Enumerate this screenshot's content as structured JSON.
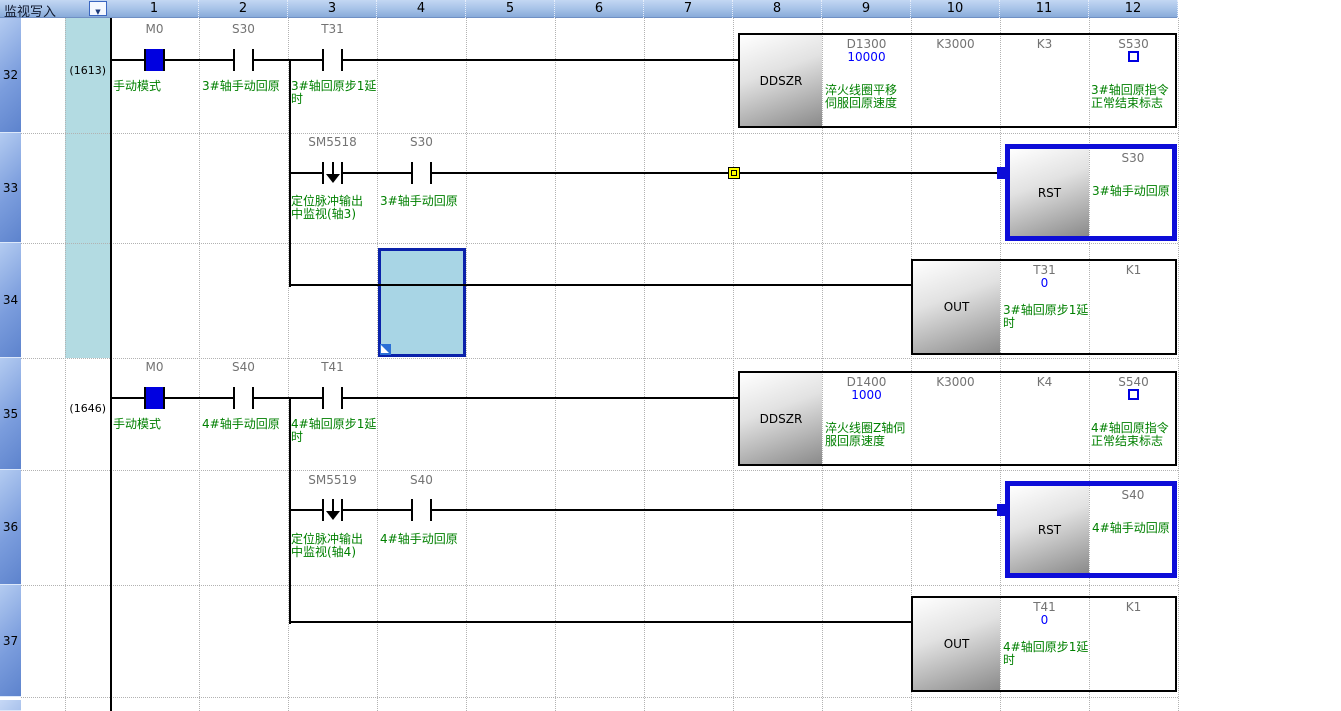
{
  "colors": {
    "comment_green": "#008000",
    "monitor_value_blue": "#0000ff",
    "on_state_blue": "#0000e0",
    "selection_blue": "#0d0dd8",
    "cursor_cell_fill": "#a8d5e5",
    "step_column_fill": "#b3dbe2",
    "marker_yellow": "#ffff00"
  },
  "header": {
    "mode_label": "监视写入",
    "dropdown_icon": "▼",
    "columns": [
      "1",
      "2",
      "3",
      "4",
      "5",
      "6",
      "7",
      "8",
      "9",
      "10",
      "11",
      "12"
    ]
  },
  "rows": [
    {
      "number": "32",
      "step": "(1613)"
    },
    {
      "number": "33",
      "step": ""
    },
    {
      "number": "34",
      "step": ""
    },
    {
      "number": "35",
      "step": "(1646)"
    },
    {
      "number": "36",
      "step": ""
    },
    {
      "number": "37",
      "step": ""
    },
    {
      "number": "",
      "step": ""
    }
  ],
  "rung32": {
    "contact1_device": "M0",
    "contact1_comment": "手动模式",
    "contact2_device": "S30",
    "contact2_comment": "3#轴手动回原",
    "contact3_device": "T31",
    "contact3_comment": "3#轴回原步1延\n时",
    "block": "DDSZR",
    "op1_device": "D1300",
    "op1_value": "10000",
    "op1_comment": "淬火线圈平移\n伺服回原速度",
    "op2_device": "K3000",
    "op3_device": "K3",
    "op4_device": "S530",
    "op4_comment": "3#轴回原指令\n正常结束标志"
  },
  "rung33": {
    "contact1_device": "SM5518",
    "contact1_comment": "定位脉冲输出\n中监视(轴3)",
    "contact2_device": "S30",
    "contact2_comment": "3#轴手动回原",
    "block": "RST",
    "op1_device": "S30",
    "op1_comment": "3#轴手动回原"
  },
  "rung34": {
    "block": "OUT",
    "op1_device": "T31",
    "op1_value": "0",
    "op1_comment": "3#轴回原步1延\n时",
    "op2_device": "K1"
  },
  "rung35": {
    "contact1_device": "M0",
    "contact1_comment": "手动模式",
    "contact2_device": "S40",
    "contact2_comment": "4#轴手动回原",
    "contact3_device": "T41",
    "contact3_comment": "4#轴回原步1延\n时",
    "block": "DDSZR",
    "op1_device": "D1400",
    "op1_value": "1000",
    "op1_comment": "淬火线圈Z轴伺\n服回原速度",
    "op2_device": "K3000",
    "op3_device": "K4",
    "op4_device": "S540",
    "op4_comment": "4#轴回原指令\n正常结束标志"
  },
  "rung36": {
    "contact1_device": "SM5519",
    "contact1_comment": "定位脉冲输出\n中监视(轴4)",
    "contact2_device": "S40",
    "contact2_comment": "4#轴手动回原",
    "block": "RST",
    "op1_device": "S40",
    "op1_comment": "4#轴手动回原"
  },
  "rung37": {
    "block": "OUT",
    "op1_device": "T41",
    "op1_value": "0",
    "op1_comment": "4#轴回原步1延\n时",
    "op2_device": "K1"
  }
}
